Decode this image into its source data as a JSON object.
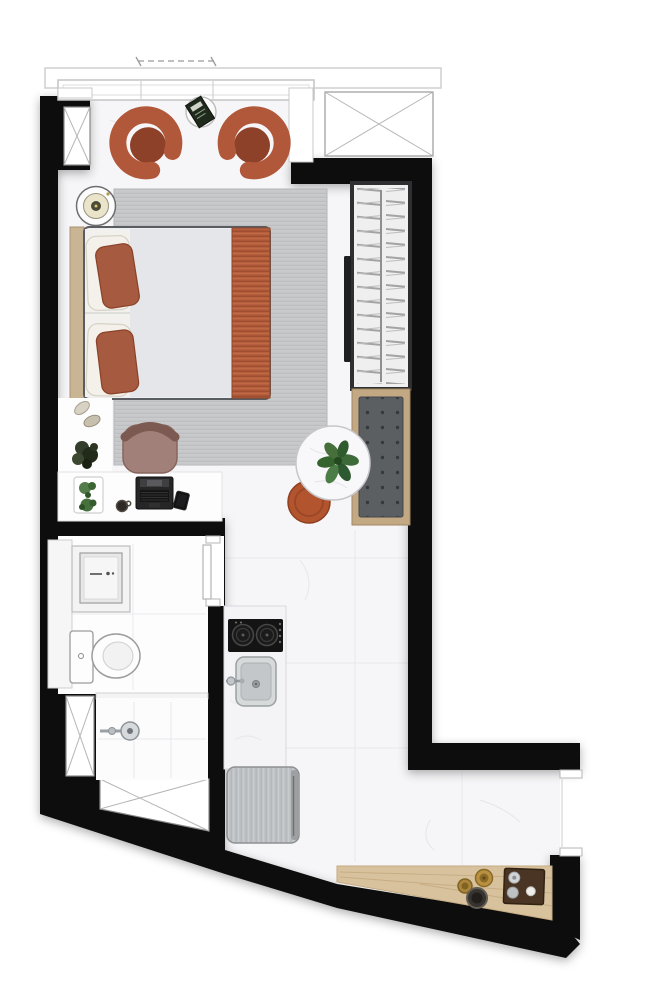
{
  "title": "Studio Apartment Floor Plan",
  "palette": {
    "wall": "#0d0d0d",
    "floor": "#f6f6f8",
    "bathroom_floor": "#fdfdfe",
    "rug_base": "#cccdcf",
    "terracotta": "#b2583a",
    "terracotta_seat": "#8e4129",
    "pouf": "#b2542e",
    "blanket": "#b65f3e",
    "deck": "#d8c29e",
    "bench_frame": "#c3a884",
    "bench_cushion": "#5b5f62",
    "headboard_wood": "#c9b493",
    "mattress": "#edeef0",
    "desk_chair": "#a08078",
    "stainless": "#c0c3c5",
    "plant_green": "#3c6a39",
    "fixture_white": "#fdfdfd"
  },
  "rooms": [
    {
      "name": "bedroom-living"
    },
    {
      "name": "bathroom"
    },
    {
      "name": "shower"
    },
    {
      "name": "kitchen"
    },
    {
      "name": "balcony-deck"
    }
  ],
  "furniture": [
    "armchair-left",
    "armchair-right",
    "side-table",
    "magazine",
    "double-bed",
    "pillows",
    "throw-blanket",
    "nightstand-lamp",
    "area-rug",
    "wardrobe",
    "wall-tv",
    "dining-bench",
    "dining-table",
    "monstera-plant",
    "pouf",
    "desk",
    "desk-chair",
    "laptop",
    "smartphone",
    "coffee-cup",
    "plant-tray",
    "slippers",
    "decor-plant",
    "vanity-sink",
    "toilet",
    "shower-head",
    "bathroom-door",
    "cooktop",
    "kitchen-sink",
    "kitchen-counter",
    "refrigerator",
    "deck-tray",
    "brass-pots",
    "charcoal-bowl"
  ]
}
